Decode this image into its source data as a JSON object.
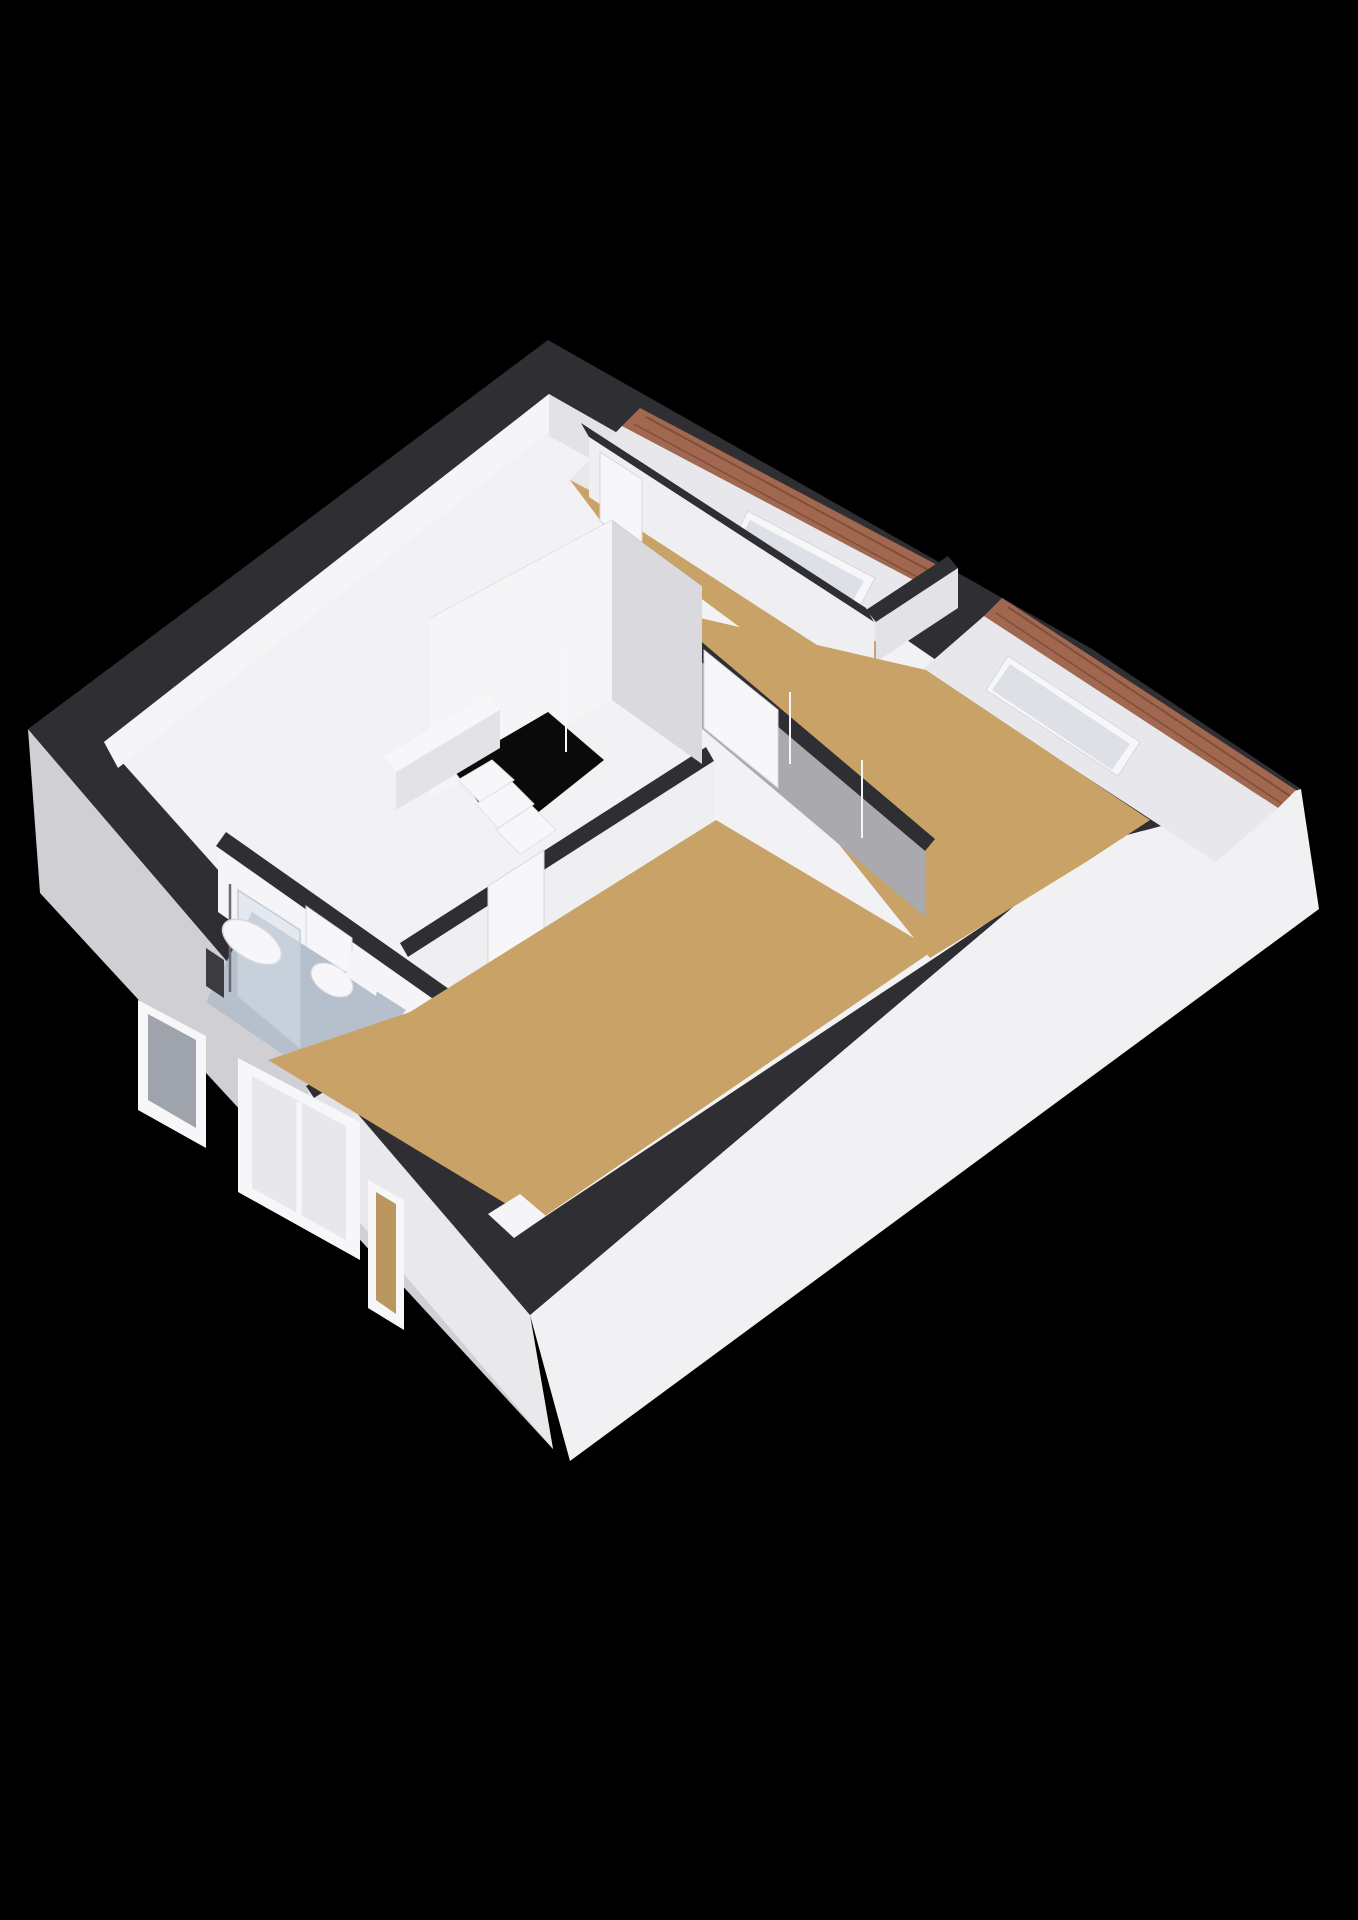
{
  "scene": {
    "title": "3d-floor-plan-attic-level",
    "background_color": "#000000",
    "rooms": [
      "landing",
      "bathroom",
      "bedroom-top",
      "bedroom-east",
      "bedroom-south"
    ],
    "fixtures": [
      "shower",
      "sink",
      "toilet",
      "staircase",
      "skylight",
      "skylight",
      "dormer-windows"
    ],
    "colors": {
      "top": "#2f2f33",
      "ext1": "#cfcfd4",
      "ext2": "#e9e9ec",
      "ext3": "#f1f1f3",
      "floorWhite": "#f2f2f4",
      "floorWood": "#c8a266",
      "floorWood2": "#b9975f",
      "floorBath": "#b6c0cc",
      "brick": "#a2684f",
      "brickDark": "#7e4f3a",
      "slope": "#e7e7ec",
      "white": "#f7f7f9",
      "pane": "#dde1e7",
      "paneDark": "#9fa3ab",
      "paneLight": "#e8e8ec",
      "wallBright": "#f5f5f7",
      "wallBright2": "#efeff2",
      "wallMid": "#e3e3e7",
      "wallMid2": "#dadade",
      "wallGray": "#a9a9ae",
      "glass": "rgba(214,223,233,0.55)",
      "glassEdge": "#c3ccd6",
      "chrome": "#6a6a70",
      "dark2": "#3c3c40",
      "hole": "#0a0a0a",
      "stroke1": "#d8d8dc"
    },
    "layers": [
      {
        "name": "sw-exterior-wall-face",
        "type": "polygon",
        "points": "28,729 530,1315 553,1449 40,893",
        "fill": "ext1"
      },
      {
        "name": "sw-exterior-wall-face-right",
        "type": "polygon",
        "points": "300,1043 530,1315 553,1449 322,1178",
        "fill": "ext2"
      },
      {
        "name": "se-exterior-wall-face",
        "type": "polygon",
        "points": "530,1315 1085,846 1301,789 1319,909 570,1461",
        "fill": "ext3"
      },
      {
        "name": "wall-top-silhouette",
        "type": "polygon",
        "points": "28,729 548,340 1092,649 1301,789 1085,846 530,1315",
        "fill": "top"
      },
      {
        "name": "landing-floor",
        "type": "polygon",
        "points": "104,742 549,394 1000,704 1085,858 534,1224",
        "fill": "floorWhite"
      },
      {
        "name": "nw-inner-wall-face",
        "type": "polygon",
        "points": "104,742 549,394 549,432 118,768",
        "fill": "wallBright"
      },
      {
        "name": "ne-inner-wall-face",
        "type": "polygon",
        "points": "549,394 644,448 644,488 549,436",
        "fill": "wallMid"
      },
      {
        "name": "brick-edge-gable1",
        "type": "polygon",
        "points": "640,408 958,576 940,594 622,426",
        "fill": "brick"
      },
      {
        "name": "brick-line-g1a",
        "type": "line",
        "x1": 646,
        "y1": 417,
        "x2": 952,
        "y2": 583,
        "fill": "none",
        "stroke": "brickDark",
        "strokeWidth": 2
      },
      {
        "name": "brick-line-g1b",
        "type": "line",
        "x1": 634,
        "y1": 424,
        "x2": 941,
        "y2": 590,
        "fill": "none",
        "stroke": "brickDark",
        "strokeWidth": 1.5
      },
      {
        "name": "roof-slope-face-gable1",
        "type": "polygon",
        "points": "622,426 940,594 886,650 568,482",
        "fill": "slope"
      },
      {
        "name": "skylight1-frame",
        "type": "polygon",
        "points": "748,511 875,578 855,616 728,549",
        "fill": "white",
        "stroke": "stroke1",
        "strokeWidth": 1
      },
      {
        "name": "skylight1-pane",
        "type": "polygon",
        "points": "750,520 864,581 850,606 736,547",
        "fill": "pane"
      },
      {
        "name": "brick-edge-gable2",
        "type": "polygon",
        "points": "1002,598 1296,790 1278,808 984,616",
        "fill": "brick"
      },
      {
        "name": "brick-line-g2a",
        "type": "line",
        "x1": 1008,
        "y1": 607,
        "x2": 1290,
        "y2": 796,
        "fill": "none",
        "stroke": "brickDark",
        "strokeWidth": 2
      },
      {
        "name": "brick-line-g2b",
        "type": "line",
        "x1": 996,
        "y1": 613,
        "x2": 1281,
        "y2": 803,
        "fill": "none",
        "stroke": "brickDark",
        "strokeWidth": 1.5
      },
      {
        "name": "roof-slope-face-gable2",
        "type": "polygon",
        "points": "984,616 1278,808 1216,862 922,670",
        "fill": "slope"
      },
      {
        "name": "skylight2-frame",
        "type": "polygon",
        "points": "1008,656 1140,742 1118,776 986,690",
        "fill": "white",
        "stroke": "stroke1",
        "strokeWidth": 1
      },
      {
        "name": "skylight2-pane",
        "type": "polygon",
        "points": "1010,664 1130,744 1112,770 992,690",
        "fill": "pane"
      },
      {
        "name": "bedroom-top-floor",
        "type": "polygon",
        "points": "570,480 888,648 838,700 606,528",
        "fill": "floorWood"
      },
      {
        "name": "bedroom-top-sw-wall-top",
        "type": "polygon",
        "points": "581,423 866,608 874,622 589,437",
        "fill": "top"
      },
      {
        "name": "bedroom-top-sw-wall-face",
        "type": "polygon",
        "points": "589,437 874,622 874,682 589,497",
        "fill": "wallBright2"
      },
      {
        "name": "bedroom-top-door-panel",
        "type": "polygon",
        "points": "600,452 642,479 642,549 600,521",
        "fill": "white",
        "stroke": "stroke1",
        "strokeWidth": 1
      },
      {
        "name": "bedroom-top-se-wall-top",
        "type": "polygon",
        "points": "866,610 948,556 958,568 876,622",
        "fill": "top"
      },
      {
        "name": "bedroom-top-se-wall-face",
        "type": "polygon",
        "points": "876,622 958,568 958,608 876,662",
        "fill": "wallMid"
      },
      {
        "name": "bedroom-east-floor",
        "type": "polygon",
        "points": "648,606 926,670 1150,820 1086,862 930,958",
        "fill": "floorWood"
      },
      {
        "name": "bedroom-east-sw-wall-top",
        "type": "polygon",
        "points": "645,594 935,839 925,851 635,606",
        "fill": "top"
      },
      {
        "name": "bedroom-east-sw-wall-face",
        "type": "polygon",
        "points": "635,606 925,851 925,917 635,672",
        "fill": "wallGray"
      },
      {
        "name": "bedroom-east-door-panel",
        "type": "polygon",
        "points": "704,650 778,710 778,788 704,728",
        "fill": "white",
        "stroke": "stroke1",
        "strokeWidth": 1
      },
      {
        "name": "landing-se-wall-top",
        "type": "polygon",
        "points": "400,943 706,747 714,761 408,957",
        "fill": "top"
      },
      {
        "name": "landing-se-wall-face",
        "type": "polygon",
        "points": "408,957 714,761 714,821 408,1017",
        "fill": "wallBright2"
      },
      {
        "name": "bedroom-south-door-panel",
        "type": "polygon",
        "points": "488,886 544,850 544,932 488,968",
        "fill": "white",
        "stroke": "stroke1",
        "strokeWidth": 1
      },
      {
        "name": "bathroom-ne-wall-top",
        "type": "polygon",
        "points": "226,832 456,994 446,1008 216,846",
        "fill": "top"
      },
      {
        "name": "bathroom-ne-wall-face",
        "type": "polygon",
        "points": "218,848 448,1010 448,1074 218,912",
        "fill": "wallBright"
      },
      {
        "name": "bathroom-door-panel",
        "type": "polygon",
        "points": "306,906 352,938 352,1014 306,978",
        "fill": "white",
        "stroke": "stroke1",
        "strokeWidth": 1
      },
      {
        "name": "bathroom-se-wall-top",
        "type": "polygon",
        "points": "306,1086 448,998 456,1010 314,1098",
        "fill": "top"
      },
      {
        "name": "bathroom-se-wall-face",
        "type": "polygon",
        "points": "314,1098 456,1010 456,1052 314,1140",
        "fill": "wallMid"
      },
      {
        "name": "bathroom-floor",
        "type": "polygon",
        "points": "252,912 406,1010 338,1092 206,1002",
        "fill": "floorBath"
      },
      {
        "name": "shower-glass-panel",
        "type": "polygon",
        "points": "238,890 300,930 300,1048 238,996",
        "fill": "glass",
        "stroke": "glassEdge",
        "strokeWidth": 1.5
      },
      {
        "name": "shower-pole",
        "type": "line",
        "x1": 230,
        "y1": 884,
        "x2": 230,
        "y2": 992,
        "fill": "none",
        "stroke": "chrome",
        "strokeWidth": 2.5
      },
      {
        "name": "shower-head-fixture",
        "type": "polygon",
        "points": "206,948 224,960 224,998 206,986",
        "fill": "dark2"
      },
      {
        "name": "sink-basin",
        "type": "ellipse",
        "cx": 252,
        "cy": 942,
        "rx": 33,
        "ry": 17,
        "rotate": 32,
        "fill": "white",
        "stroke": "stroke1",
        "strokeWidth": 1.5
      },
      {
        "name": "toilet-bowl",
        "type": "ellipse",
        "cx": 332,
        "cy": 980,
        "rx": 23,
        "ry": 14,
        "rotate": 32,
        "fill": "white",
        "stroke": "stroke1",
        "strokeWidth": 1
      },
      {
        "name": "toilet-tank",
        "type": "polygon",
        "points": "350,950 380,970 376,996 346,976",
        "fill": "wallBright"
      },
      {
        "name": "bedroom-south-floor",
        "type": "polygon",
        "points": "410,1012 716,820 934,950 536,1222 268,1060",
        "fill": "floorWood"
      },
      {
        "name": "corner-column",
        "type": "polygon",
        "points": "488,1214 520,1194 546,1216 514,1238",
        "fill": "wallBright"
      },
      {
        "name": "stair-enclosure-top",
        "type": "polygon",
        "points": "430,618 612,520 702,586 520,686",
        "fill": "top"
      },
      {
        "name": "stair-enclosure-sw-face",
        "type": "polygon",
        "points": "430,618 612,520 612,700 430,798",
        "fill": "wallBright"
      },
      {
        "name": "stair-enclosure-se-face",
        "type": "polygon",
        "points": "612,520 702,586 702,764 612,700",
        "fill": "wallMid2"
      },
      {
        "name": "stair-opening-hole",
        "type": "polygon",
        "points": "452,768 548,712 604,760 506,838",
        "fill": "hole"
      },
      {
        "name": "stair-step-1",
        "type": "polygon",
        "points": "458,780 492,760 514,780 480,802",
        "fill": "white",
        "stroke": "wallMid",
        "strokeWidth": 1
      },
      {
        "name": "stair-step-2",
        "type": "polygon",
        "points": "476,804 512,782 534,804 498,828",
        "fill": "white",
        "stroke": "wallMid",
        "strokeWidth": 1
      },
      {
        "name": "stair-step-3",
        "type": "polygon",
        "points": "496,830 532,806 556,830 520,854",
        "fill": "white",
        "stroke": "wallMid",
        "strokeWidth": 1
      },
      {
        "name": "banister-top",
        "type": "polygon",
        "points": "384,756 488,696 500,710 396,772",
        "fill": "white"
      },
      {
        "name": "banister-face",
        "type": "polygon",
        "points": "396,772 500,710 500,748 396,810",
        "fill": "wallMid"
      },
      {
        "name": "bathroom-window-frame",
        "type": "polygon",
        "points": "138,1000 206,1036 206,1148 138,1110",
        "fill": "white"
      },
      {
        "name": "bathroom-window-pane",
        "type": "polygon",
        "points": "148,1014 196,1040 196,1128 148,1100",
        "fill": "paneDark"
      },
      {
        "name": "dormer-window1-frame",
        "type": "polygon",
        "points": "238,1058 360,1122 360,1260 238,1192",
        "fill": "white"
      },
      {
        "name": "dormer-window1-pane",
        "type": "polygon",
        "points": "252,1076 346,1126 346,1240 252,1188",
        "fill": "paneLight"
      },
      {
        "name": "dormer-window1-mullion",
        "type": "line",
        "x1": 299,
        "y1": 1102,
        "x2": 299,
        "y2": 1215,
        "fill": "none",
        "stroke": "white",
        "strokeWidth": 5
      },
      {
        "name": "dormer-window2-frame",
        "type": "polygon",
        "points": "368,1180 404,1200 404,1330 368,1308",
        "fill": "white"
      },
      {
        "name": "dormer-window2-pane",
        "type": "polygon",
        "points": "376,1192 396,1204 396,1314 376,1300",
        "fill": "floorWood2"
      },
      {
        "name": "door-trim-line-1",
        "type": "line",
        "x1": 566,
        "y1": 648,
        "x2": 566,
        "y2": 752,
        "fill": "none",
        "stroke": "white",
        "strokeWidth": 2
      },
      {
        "name": "door-trim-line-2",
        "type": "line",
        "x1": 790,
        "y1": 692,
        "x2": 790,
        "y2": 764,
        "fill": "none",
        "stroke": "white",
        "strokeWidth": 2
      },
      {
        "name": "door-trim-line-3",
        "type": "line",
        "x1": 862,
        "y1": 760,
        "x2": 862,
        "y2": 838,
        "fill": "none",
        "stroke": "white",
        "strokeWidth": 2
      }
    ]
  }
}
